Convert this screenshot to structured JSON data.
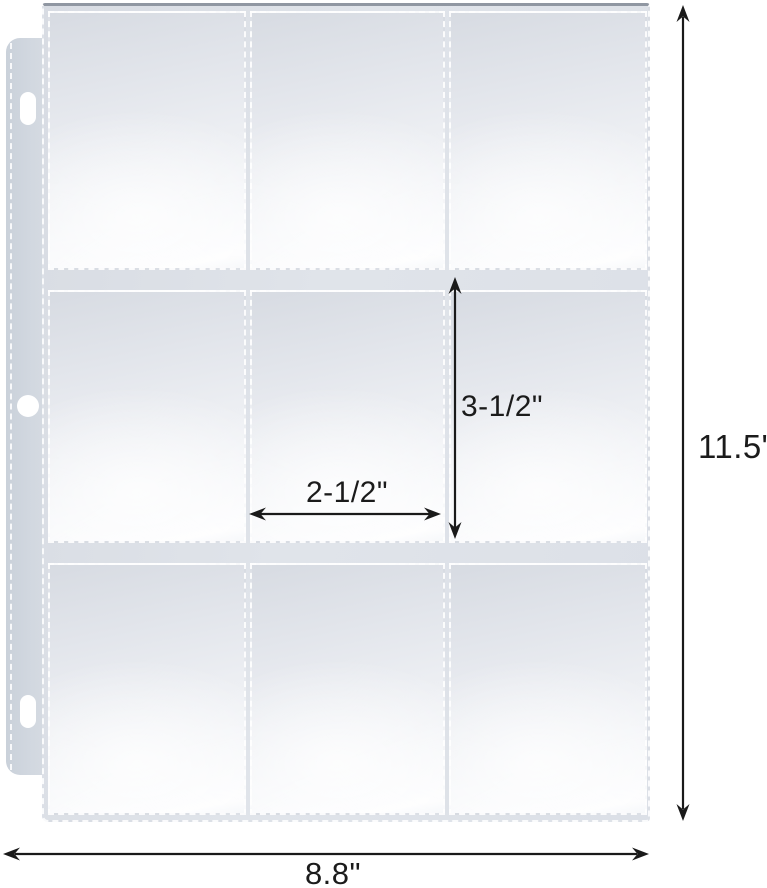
{
  "page": {
    "background": "#ffffff",
    "product": {
      "name": "9-pocket-page",
      "description": "Clear plastic 9-pocket binder page for trading cards",
      "grid_rows": 3,
      "grid_cols": 3,
      "pocket_count": 9,
      "binder_holes": 3
    },
    "dimensions": {
      "page_width_label": "8.8\"",
      "page_height_label": "11.5\"",
      "pocket_width_label": "2-1/2\"",
      "pocket_height_label": "3-1/2\""
    },
    "icons": {
      "page_height_arrow": "double-headed-vertical-arrow",
      "page_width_arrow": "double-headed-horizontal-arrow",
      "pocket_height_arrow": "double-headed-vertical-arrow",
      "pocket_width_arrow": "double-headed-horizontal-arrow"
    },
    "colors": {
      "sheet_base": "#dde1e8",
      "pocket_highlight": "#fbfcfd",
      "binder_strip": "#cdd4dd",
      "stitch": "#ffffff",
      "arrow": "#1a1a1a",
      "sheet_top_edge": "#9097a2"
    }
  }
}
